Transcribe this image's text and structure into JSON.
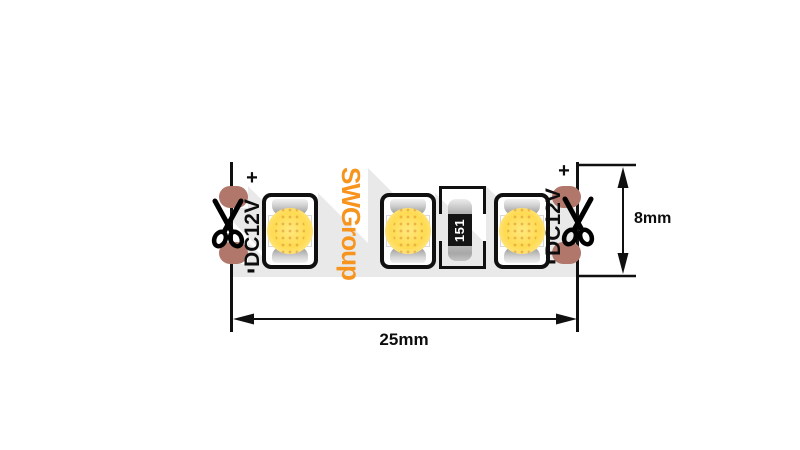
{
  "strip": {
    "logo": "SWGroup",
    "led_count": 3,
    "left_marking": {
      "plus": "+",
      "voltage": "DC12V",
      "minus": "-"
    },
    "right_marking": {
      "plus": "+",
      "voltage": "DC12V",
      "minus": "-"
    },
    "resistor_value": "151",
    "colors": {
      "logo_orange": "#f7941e",
      "pad_copper": "#b1776a",
      "shadow_gray": "#e9e9e9",
      "led_yellow": "#ffdb52",
      "outline_black": "#101010"
    }
  },
  "dimensions": {
    "width": "25mm",
    "height": "8mm"
  },
  "icons": {
    "left_cut": "scissors-icon",
    "right_cut": "scissors-icon"
  }
}
